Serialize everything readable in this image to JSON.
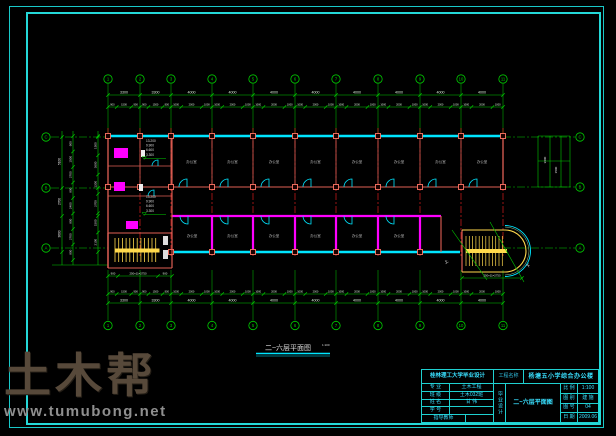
{
  "watermark": {
    "logo": "土木帮",
    "url": "www.tumubong.net"
  },
  "plan": {
    "title": "二~六层平面图",
    "scale": "1:100",
    "axes_top": [
      "1",
      "2",
      "3",
      "4",
      "5",
      "6",
      "7",
      "8",
      "9",
      "10",
      "11"
    ],
    "axes_bottom": [
      "1",
      "2",
      "3",
      "4",
      "5",
      "6",
      "7",
      "8",
      "9",
      "10",
      "11"
    ],
    "axes_left": [
      "C",
      "B",
      "A"
    ],
    "axes_right": [
      "C",
      "B",
      "A"
    ],
    "dims_top_bays": [
      "3300",
      "3300",
      "4000",
      "4000",
      "4000",
      "4000",
      "4000",
      "4000",
      "4000",
      "4000"
    ],
    "dims_top_detail": [
      [
        "900",
        "1500",
        "900"
      ],
      [
        "900",
        "1500",
        "900"
      ],
      [
        "1000",
        "2000",
        "1000"
      ],
      [
        "1000",
        "2000",
        "1000"
      ],
      [
        "1000",
        "2000",
        "1000"
      ],
      [
        "1000",
        "2000",
        "1000"
      ],
      [
        "1000",
        "2000",
        "1000"
      ],
      [
        "1000",
        "2000",
        "1000"
      ],
      [
        "1000",
        "2000",
        "1000"
      ],
      [
        "1000",
        "2000",
        "1000"
      ]
    ],
    "dims_bottom_bays": [
      "3300",
      "3300",
      "4000",
      "4000",
      "4000",
      "4000",
      "4000",
      "4000",
      "4000",
      "4000"
    ],
    "dims_bottom_detail": [
      [
        "900",
        "1500",
        "900"
      ],
      [
        "900",
        "1500",
        "900"
      ],
      [
        "1000",
        "2000",
        "1000"
      ],
      [
        "1000",
        "2000",
        "1000"
      ],
      [
        "1000",
        "2000",
        "1000"
      ],
      [
        "1000",
        "2000",
        "1000"
      ],
      [
        "1000",
        "2000",
        "1000"
      ],
      [
        "1000",
        "2000",
        "1000"
      ],
      [
        "1000",
        "2000",
        "1000"
      ],
      [
        "1000",
        "2000",
        "1000"
      ]
    ],
    "dims_left_outer": [
      "5100",
      "2700",
      "3600"
    ],
    "dims_left_mid": [
      "900",
      "1500",
      "2700",
      "900",
      "2400",
      "900",
      "2700",
      "900"
    ],
    "dims_left_inner": [
      "1500",
      "3600",
      "1200",
      "2700",
      "1500",
      "2100"
    ],
    "dims_right_wing": [
      "3600",
      "1500"
    ],
    "elevations": [
      "13.200",
      "9.900",
      "6.600",
      "3.300"
    ],
    "stair_dim": "250×11=2750",
    "stair_side": [
      "900",
      "900"
    ],
    "room_label": "办公室",
    "tag_up": "上",
    "tag_down": "下"
  },
  "title_block": {
    "school": "桂林理工大学毕业设计",
    "project_label": "工程名称",
    "project_name": "杨塘五小学综合办公楼",
    "stage_vertical": "毕业设计",
    "drawing_name": "二~六层平面图",
    "rows": [
      {
        "label": "专 业",
        "value": "土木工程"
      },
      {
        "label": "班 级",
        "value": "土木032班"
      },
      {
        "label": "姓 名",
        "value": "甘 伟"
      },
      {
        "label": "学 号",
        "value": ""
      },
      {
        "label": "指导教师",
        "value": ""
      }
    ],
    "meta": [
      {
        "label": "比 例",
        "value": "1:100"
      },
      {
        "label": "图 别",
        "value": "建 施"
      },
      {
        "label": "图 号",
        "value": "04"
      },
      {
        "label": "日 期",
        "value": "2009.06"
      }
    ]
  }
}
